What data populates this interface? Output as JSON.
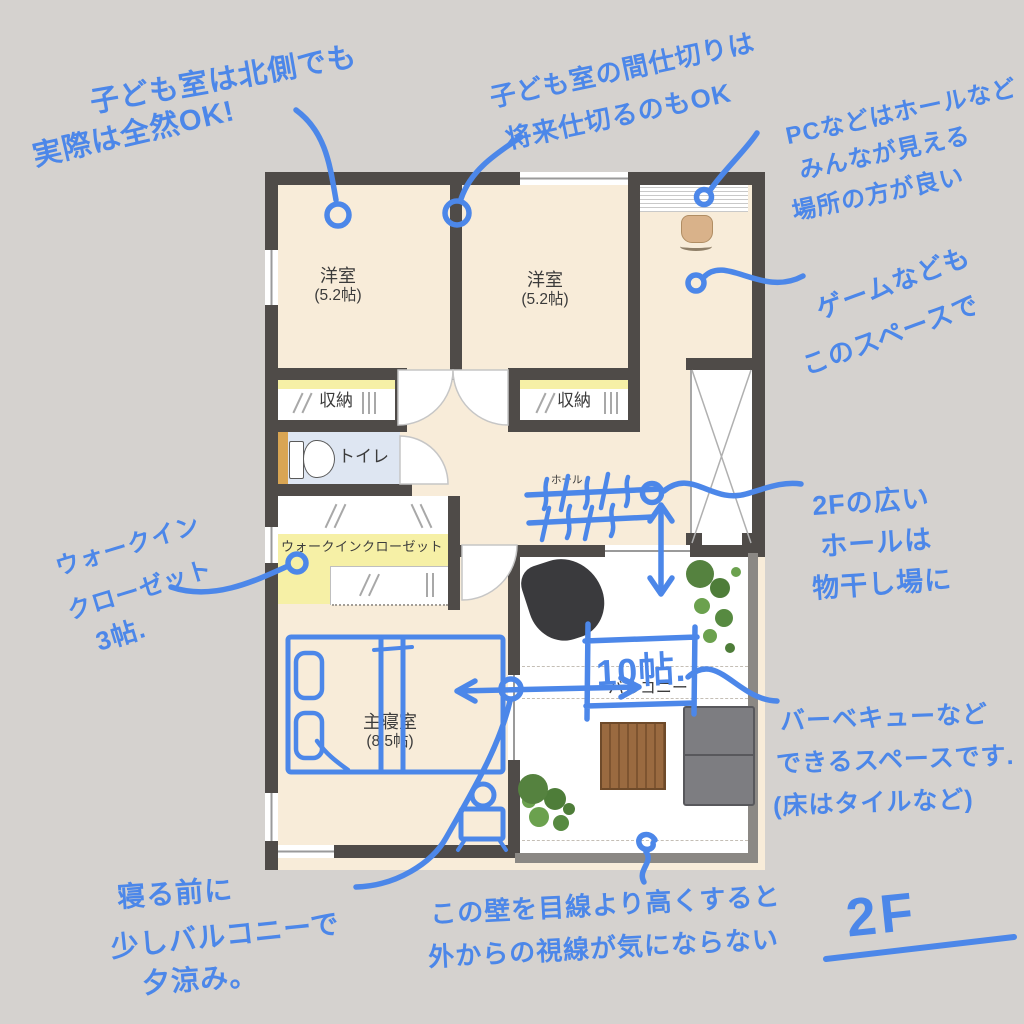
{
  "floor_label": "2F",
  "rooms": {
    "room1": {
      "name": "洋室",
      "size": "(5.2帖)"
    },
    "room2": {
      "name": "洋室",
      "size": "(5.2帖)"
    },
    "closet1": {
      "name": "収納"
    },
    "closet2": {
      "name": "収納"
    },
    "toilet": {
      "name": "トイレ"
    },
    "wic": {
      "name": "ウォークインクローゼット"
    },
    "hall": {
      "name": "ホール"
    },
    "master": {
      "name": "主寝室",
      "size": "(8.5帖)"
    },
    "balcony": {
      "name": "バルコニー",
      "area_note": "10帖."
    }
  },
  "annotations": {
    "kids_north": {
      "lines": [
        "子ども室は北側でも",
        "実際は全然OK!"
      ]
    },
    "kids_partition": {
      "lines": [
        "子ども室の間仕切りは",
        "将来仕切るのもOK"
      ]
    },
    "pc_hall": {
      "lines": [
        "PCなどはホールなど",
        "みんなが見える",
        "場所の方が良い"
      ]
    },
    "game_space": {
      "lines": [
        "ゲームなども",
        "このスペースで"
      ]
    },
    "hall_drying": {
      "lines": [
        "2Fの広い",
        "ホールは",
        "物干し場に"
      ]
    },
    "wic_note": {
      "lines": [
        "ウォークイン",
        "クローゼット",
        "3帖."
      ]
    },
    "bbq_space": {
      "lines": [
        "バーベキューなど",
        "できるスペースです.",
        "(床はタイルなど)"
      ]
    },
    "evening_cool": {
      "lines": [
        "寝る前に",
        "少しバルコニーで",
        "夕涼み。"
      ]
    },
    "wall_height": {
      "lines": [
        "この壁を目線より高くすると",
        "外からの視線が気にならない"
      ]
    }
  },
  "colors": {
    "ink_blue": "#4c87e9",
    "wall": "#4f4b48",
    "floor_cream": "#f8ecd9",
    "closet_yellow": "#f6f0a6",
    "toilet_blue": "#dee6f2",
    "background": "#d5d2cf"
  }
}
